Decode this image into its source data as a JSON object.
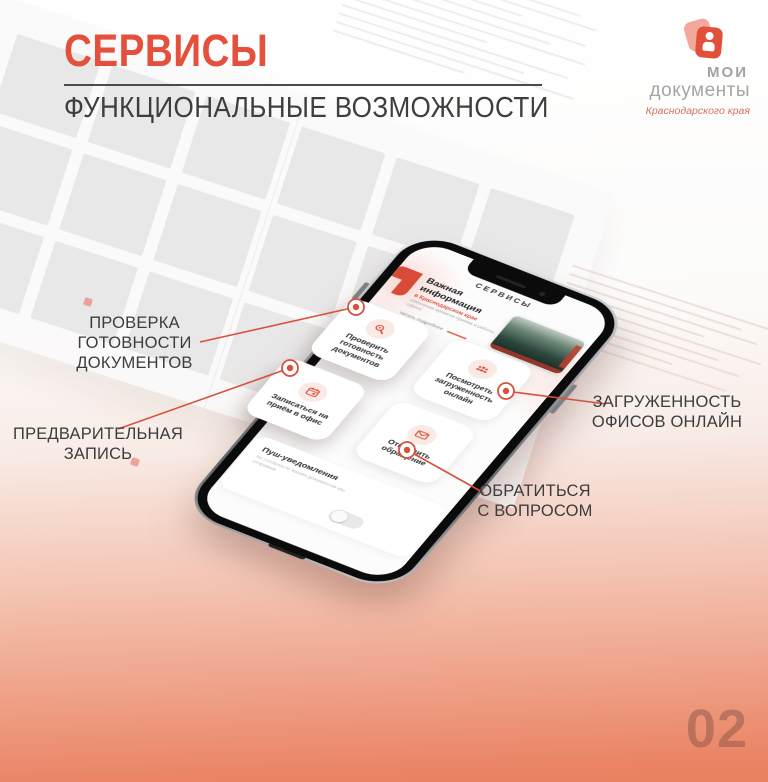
{
  "slide": {
    "title": "СЕРВИСЫ",
    "subtitle": "ФУНКЦИОНАЛЬНЫЕ ВОЗМОЖНОСТИ",
    "page_number": "02"
  },
  "brand": {
    "line1": "МОИ",
    "line2": "документы",
    "region": "Краснодарского края"
  },
  "colors": {
    "accent": "#E2503C",
    "gradient_bottom": "#EA8468",
    "ink": "#3F3F3F"
  },
  "callouts": [
    {
      "line1": "ПРОВЕРКА ГОТОВНОСТИ",
      "line2": "ДОКУМЕНТОВ"
    },
    {
      "line1": "ПРЕДВАРИТЕЛЬНАЯ",
      "line2": "ЗАПИСЬ"
    },
    {
      "line1": "ЗАГРУЖЕННОСТЬ",
      "line2": "ОФИСОВ ОНЛАЙН"
    },
    {
      "line1": "ОБРАТИТЬСЯ",
      "line2": "С ВОПРОСОМ"
    }
  ],
  "phone": {
    "header": "СЕРВИСЫ",
    "news": {
      "title": "Важная информация",
      "highlight": "в Краснодарском крае",
      "body": "изменение времени приёма и работы офиса",
      "link": "читать подробнее"
    },
    "cards": [
      {
        "icon": "magnifier-icon",
        "label": "Проверить готовность документов"
      },
      {
        "icon": "people-icon",
        "label": "Посмотреть загруженность онлайн"
      },
      {
        "icon": "calendar-icon",
        "label": "Записаться на приём в офис"
      },
      {
        "icon": "envelope-icon",
        "label": "Отправить обращение"
      }
    ],
    "push": {
      "title": "Пуш-уведомления",
      "body": "по готовности ваших документов мы отправим",
      "state": "off"
    }
  }
}
